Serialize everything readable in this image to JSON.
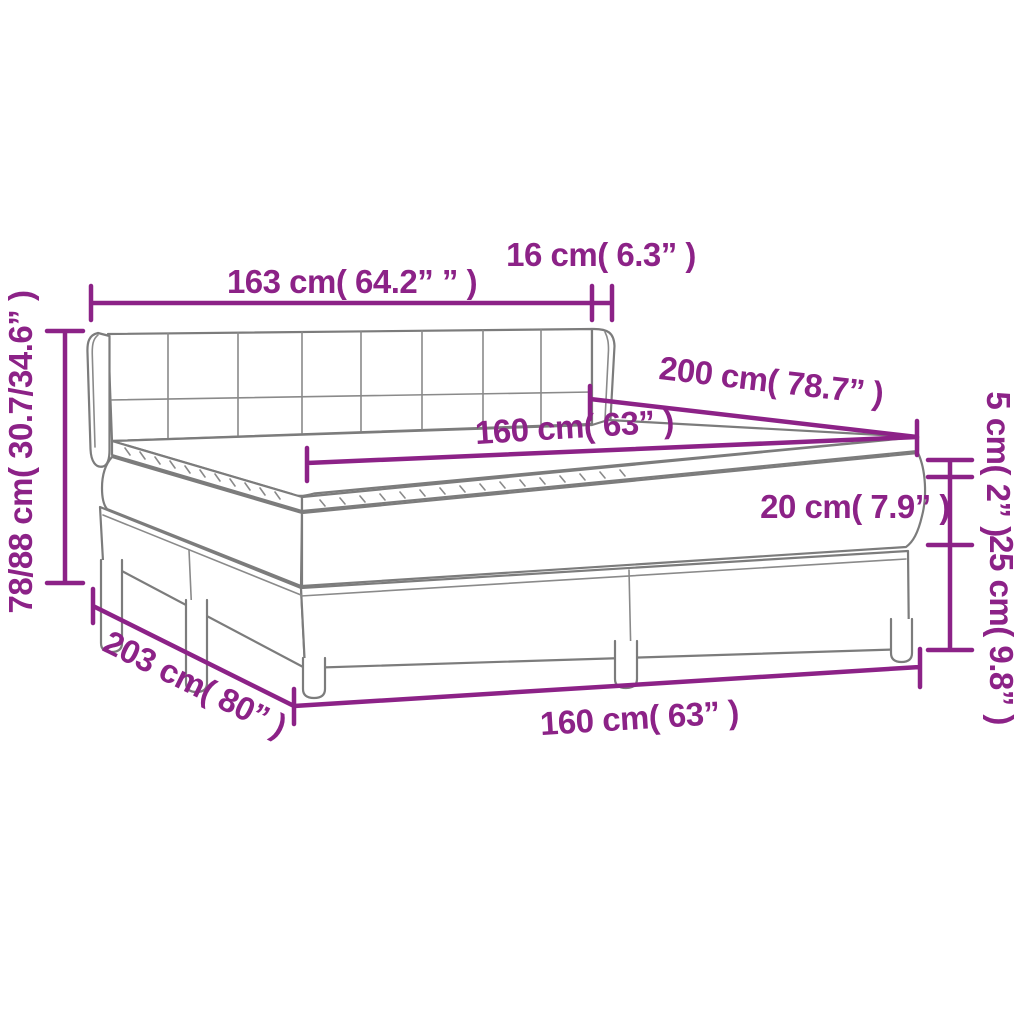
{
  "diagram": {
    "subject": "box spring bed with mattress and topper — product dimension drawing",
    "colors": {
      "accent": "#8C2287",
      "line_art": "#7C7C7C",
      "background": "#FFFFFF"
    },
    "labels": {
      "headboard_width": "163 cm( 64.2” ” )",
      "headboard_side_depth": "16 cm( 6.3” )",
      "headboard_height": "78/88 cm( 30.7/34.6” )",
      "bed_length_top": "200 cm( 78.7” )",
      "mattress_width_top": "160 cm( 63” )",
      "topper_height": "5 cm( 2” )",
      "mattress_height": "20 cm( 7.9” )",
      "base_height": "25 cm( 9.8” )",
      "bed_length_floor": "203 cm( 80” )",
      "bed_width_floor": "160 cm( 63” )"
    }
  }
}
